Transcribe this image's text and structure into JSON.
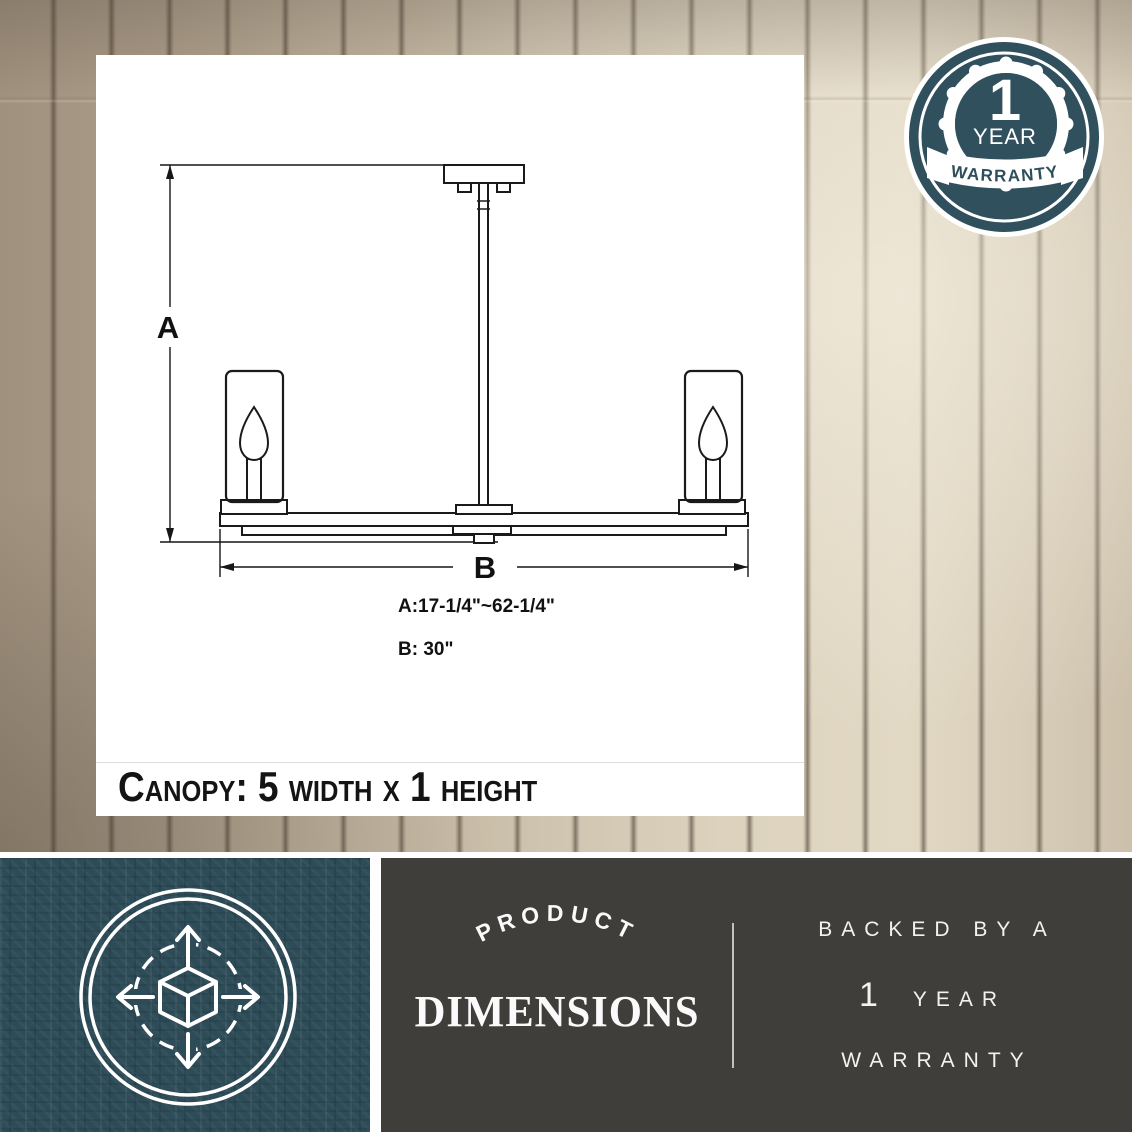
{
  "colors": {
    "badge_teal": "#30505e",
    "panel_teal": "#2d4c58",
    "panel_gray": "#403e3b",
    "ink": "#161616",
    "white": "#ffffff"
  },
  "diagram": {
    "dim_a_label": "A",
    "dim_b_label": "B",
    "dim_a_value": "A:17-1/4\"~62-1/4\"",
    "dim_b_value": "B: 30\"",
    "canopy_note": "Canopy:  5 width x 1 height"
  },
  "warranty_badge": {
    "number": "1",
    "year_label": "YEAR",
    "warranty_label": "WARRANTY"
  },
  "footer": {
    "icon": "cube-with-expand-arrows",
    "arched_label": "PRODUCT",
    "title": "DIMENSIONS",
    "backed_by": "BACKED BY A",
    "year_number": "1",
    "year_label": "YEAR",
    "warranty_label": "WARRANTY"
  }
}
